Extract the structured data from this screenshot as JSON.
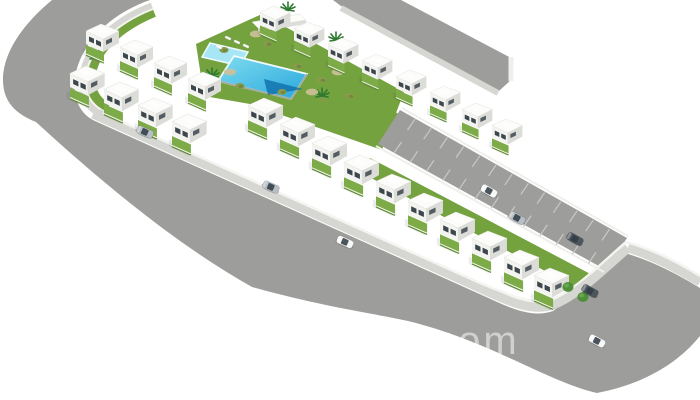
{
  "image": {
    "kind": "3d-architectural-render",
    "description": "Aerial 3D visualization of a new-build residential development: rows of white two-storey townhouses with private gardens around a communal lawn with swimming pools, bordered by curved asphalt streets with parked cars and a parking lane"
  },
  "watermark": {
    "text": "s.com",
    "color": "#ffffff",
    "opacity": 0.52
  },
  "colors": {
    "background": "#ffffff",
    "road": "#9d9d9b",
    "road_edge": "#8f8f8d",
    "sidewalk": "#d6d6d2",
    "curb_white": "#f4f4f1",
    "bay_line": "#c9c9c4",
    "lawn": "#74a23e",
    "lawn_light": "#7dab47",
    "hedge": "#5d8a30",
    "pool_light": "#7fdcf0",
    "pool_dark": "#28a7dc",
    "pool_deep": "#1272ae",
    "pool_small": "#a7e6f4",
    "pool_rim": "#f0fafc",
    "house_roof": "#fcfcfa",
    "house_front": "#f3f3f0",
    "house_side": "#dcdcd8",
    "house_eave": "#c9c9c5",
    "window": "#3c464d",
    "bush": "#8a9a50",
    "bush_dark": "#6e8a3e",
    "palm": "#2e7a31",
    "tree": "#4f8f3a",
    "gravel": "#cec19a",
    "wall_white": "#efefec"
  },
  "scene": {
    "houses": {
      "rows": [
        {
          "name": "back-row",
          "scale": 0.92,
          "units": [
            [
              260,
              6
            ],
            [
              294,
              22
            ],
            [
              328,
              38
            ],
            [
              362,
              54
            ],
            [
              396,
              70
            ],
            [
              430,
              86
            ],
            [
              462,
              103
            ],
            [
              492,
              119
            ]
          ]
        },
        {
          "name": "left-block-back",
          "scale": 1.0,
          "units": [
            [
              86,
              24
            ],
            [
              120,
              40
            ],
            [
              154,
              56
            ],
            [
              188,
              72
            ]
          ]
        },
        {
          "name": "left-block-front",
          "scale": 1.05,
          "units": [
            [
              70,
              66
            ],
            [
              104,
              82
            ],
            [
              138,
              98
            ],
            [
              172,
              114
            ]
          ]
        },
        {
          "name": "main-street-row",
          "scale": 1.06,
          "units": [
            [
              248,
              98
            ],
            [
              280,
              117
            ],
            [
              312,
              136
            ],
            [
              344,
              155
            ],
            [
              376,
              174
            ],
            [
              408,
              193
            ],
            [
              440,
              212
            ],
            [
              472,
              231
            ],
            [
              504,
              250
            ],
            [
              534,
              268
            ]
          ]
        }
      ]
    },
    "cars": [
      {
        "x": 145,
        "y": 132,
        "r": 24,
        "c": "silver"
      },
      {
        "x": 271,
        "y": 187,
        "r": 24,
        "c": "silver"
      },
      {
        "x": 345,
        "y": 242,
        "r": 24,
        "c": "white"
      },
      {
        "x": 489,
        "y": 191,
        "r": 29,
        "c": "white"
      },
      {
        "x": 517,
        "y": 218,
        "r": 29,
        "c": "silver"
      },
      {
        "x": 575,
        "y": 239,
        "r": 29,
        "c": "dark"
      },
      {
        "x": 590,
        "y": 291,
        "r": 29,
        "c": "dark"
      },
      {
        "x": 597,
        "y": 341,
        "r": 28,
        "c": "white"
      }
    ],
    "car_palette": {
      "white": "#f7f8f8",
      "silver": "#b7bfc6",
      "dark": "#4d565e"
    },
    "palms": [
      [
        96,
        58
      ],
      [
        288,
        10
      ],
      [
        336,
        40
      ],
      [
        212,
        76
      ],
      [
        322,
        96
      ]
    ],
    "trees": [
      [
        568,
        287
      ],
      [
        583,
        297
      ]
    ],
    "bushes": [
      [
        224,
        50
      ],
      [
        268,
        44
      ],
      [
        308,
        54
      ],
      [
        240,
        86
      ],
      [
        282,
        92
      ],
      [
        322,
        80
      ],
      [
        350,
        96
      ],
      [
        298,
        66
      ],
      [
        206,
        78
      ]
    ],
    "gravel": [
      [
        256,
        34
      ],
      [
        338,
        72
      ],
      [
        230,
        72
      ],
      [
        312,
        92
      ]
    ],
    "loungers": [
      [
        228,
        38
      ],
      [
        237,
        42
      ],
      [
        246,
        46
      ],
      [
        219,
        47
      ]
    ],
    "parking_bays": {
      "count": 13,
      "upper_start": [
        415,
        119
      ],
      "lower_start": [
        394,
        153
      ],
      "step": [
        16.2,
        9.2
      ],
      "tick": [
        -7.5,
        11
      ]
    }
  }
}
